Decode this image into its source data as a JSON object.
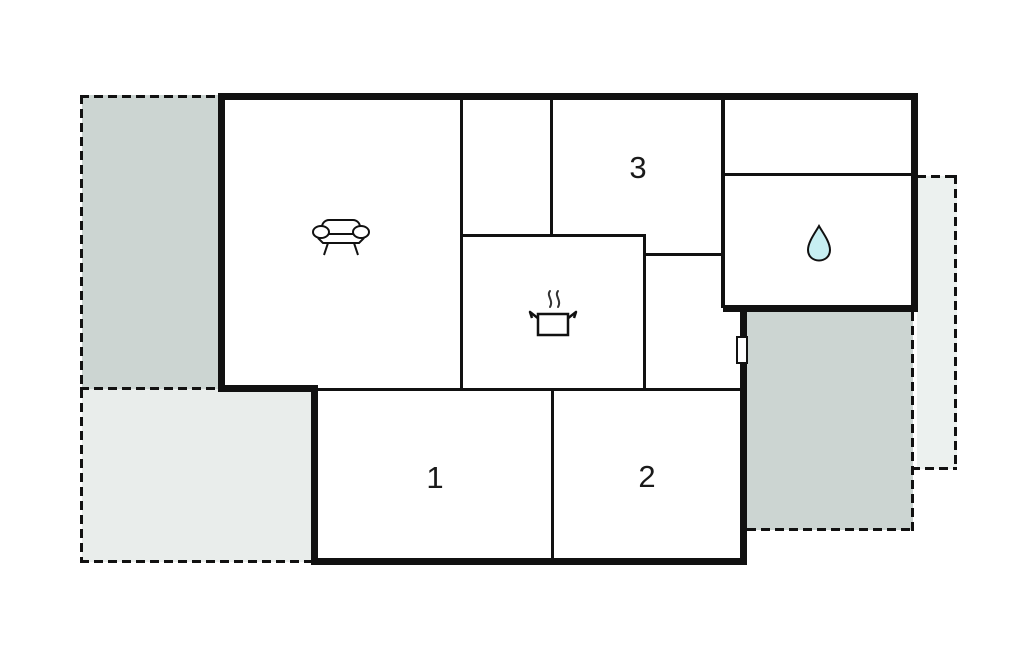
{
  "plan": {
    "type": "floor-plan",
    "rooms": {
      "living_room": {
        "icon": "sofa-icon"
      },
      "kitchen": {
        "icon": "cooking-pot-icon"
      },
      "bathroom": {
        "icon": "water-drop-icon"
      },
      "bedroom1": {
        "label": "1"
      },
      "bedroom2": {
        "label": "2"
      },
      "bedroom3": {
        "label": "3"
      }
    },
    "markers": {
      "door": "door-marker"
    },
    "colors": {
      "wall": "#111111",
      "terrace_dark": "#ccd5d2",
      "terrace_light": "#e9edeb",
      "terrace_right_strip": "#ecf1ef",
      "water_drop_fill": "#c7eff2"
    }
  }
}
